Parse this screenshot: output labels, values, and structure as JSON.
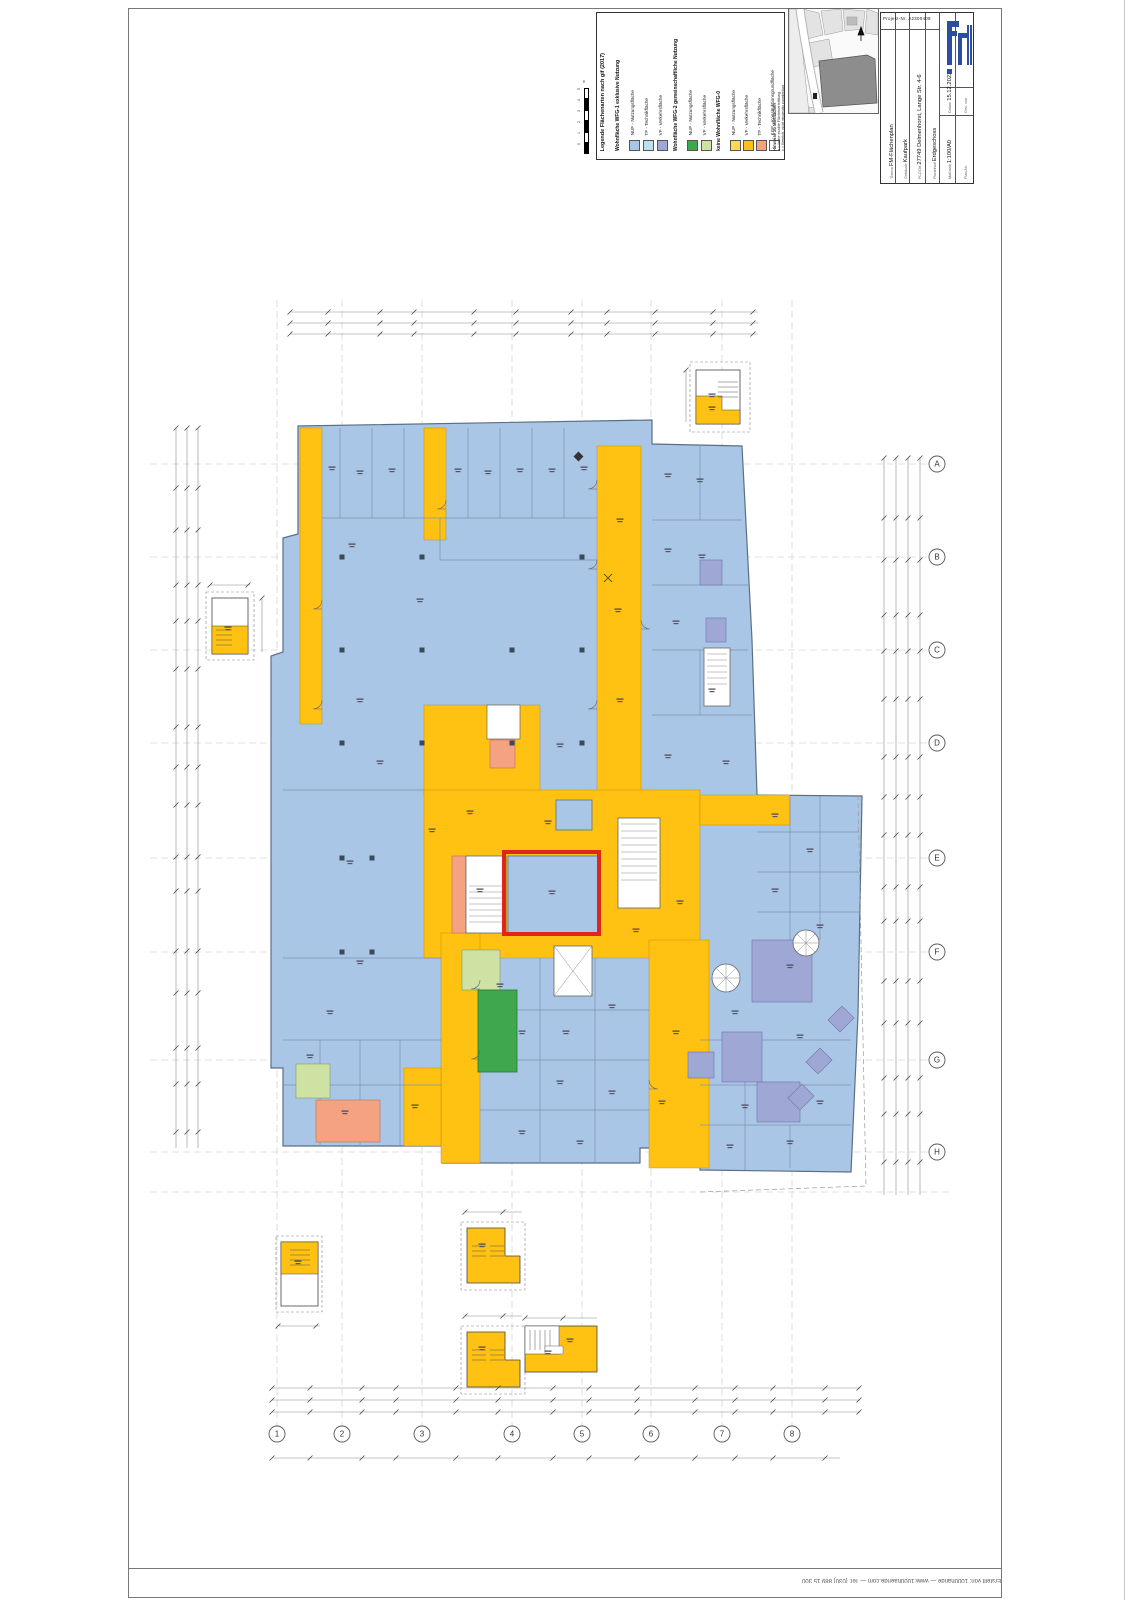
{
  "legend": {
    "title": "Legende Flächenarten nach gif (2017)",
    "groups": [
      {
        "header": "Wohnfläche WFG-1 exklusive Nutzung",
        "items": [
          {
            "label": "NUF - Nutzungsfläche",
            "color": "#A9C6E6"
          },
          {
            "label": "TF - Technikfläche",
            "color": "#BCE0EF"
          },
          {
            "label": "VF - Verkehrsfläche",
            "color": "#9FA8D5"
          }
        ]
      },
      {
        "header": "Wohnfläche WFG-2 gemeinschaftliche Nutzung",
        "items": [
          {
            "label": "NUF - Nutzungsfläche",
            "color": "#3FA84E"
          },
          {
            "label": "VF - Verkehrsfläche",
            "color": "#CDE2A3"
          }
        ]
      },
      {
        "header": "keine Wohnfläche WFG-0",
        "items": [
          {
            "label": "NUF - Nutzungsfläche",
            "color": "#FFD94F"
          },
          {
            "label": "VF - Verkehrsfläche",
            "color": "#FFC112"
          },
          {
            "label": "TF - Technikfläche",
            "color": "#F5A283"
          },
          {
            "label": "KGF - Konstruktionsgrundfläche",
            "color": "#FFFFFF"
          }
        ]
      }
    ],
    "notes": {
      "header": "Hinweise zu Mietflächen",
      "lines": [
        "a = keine exakte Flächenermittlung",
        "x = Bereich, nicht eindeutig zuordenbar"
      ]
    },
    "scale_bar": {
      "ticks": [
        "5",
        "4",
        "3",
        "2",
        "1",
        "0"
      ],
      "unit": "m"
    }
  },
  "title_block": {
    "project_label": "Projekt-Nr.",
    "project_number": "A2300409",
    "rows": [
      {
        "label": "Thema",
        "value": "FM-Flächenplan"
      },
      {
        "label": "Gebäude",
        "value": "Kaufpark"
      },
      {
        "label": "PLZ/Ort",
        "value": "27749 Delmenhorst, Lange Str. 4-6"
      },
      {
        "label": "Planinhalt",
        "value": "Erdgeschoss"
      }
    ],
    "meta": [
      {
        "label": "Datum",
        "value": "15.12.2023"
      },
      {
        "label": "Gez. von",
        "value": ""
      },
      {
        "label": "Maßstab",
        "value": "1:100/A0"
      },
      {
        "label": "Plan-Nr.",
        "value": ""
      }
    ]
  },
  "footer": {
    "credit": "Erstellt von: 1000hände  —  www.1000haende.com  —  Tel: (030) 889 15 300"
  },
  "plan": {
    "highlight_color": "#E0251B",
    "colors": {
      "wfg1_nuf_blue": "#A9C6E6",
      "wfg1_tf_lightblue": "#BCE0EF",
      "wfg1_vf_periwinkle": "#9FA8D5",
      "wfg2_nuf_green": "#3FA84E",
      "wfg2_vf_lightgreen": "#CDE2A3",
      "wfg0_nuf_yellow": "#FFD94F",
      "wfg0_vf_orange": "#FFC112",
      "wfg0_tf_salmon": "#F5A283",
      "kgf_white": "#FFFFFF"
    },
    "axes": {
      "bottom": [
        {
          "x": 277,
          "label": "1"
        },
        {
          "x": 342,
          "label": "2"
        },
        {
          "x": 422,
          "label": "3"
        },
        {
          "x": 512,
          "label": "4"
        },
        {
          "x": 582,
          "label": "5"
        },
        {
          "x": 651,
          "label": "6"
        },
        {
          "x": 722,
          "label": "7"
        },
        {
          "x": 792,
          "label": "8"
        }
      ],
      "right": [
        {
          "y": 464,
          "label": "A"
        },
        {
          "y": 557,
          "label": "B"
        },
        {
          "y": 650,
          "label": "C"
        },
        {
          "y": 743,
          "label": "D"
        },
        {
          "y": 858,
          "label": "E"
        },
        {
          "y": 952,
          "label": "F"
        },
        {
          "y": 1060,
          "label": "G"
        },
        {
          "y": 1152,
          "label": "H"
        }
      ]
    },
    "label_marks": [
      [
        332,
        468
      ],
      [
        360,
        472
      ],
      [
        392,
        470
      ],
      [
        458,
        470
      ],
      [
        488,
        472
      ],
      [
        520,
        470
      ],
      [
        552,
        470
      ],
      [
        584,
        468
      ],
      [
        352,
        545
      ],
      [
        420,
        600
      ],
      [
        360,
        700
      ],
      [
        380,
        762
      ],
      [
        350,
        862
      ],
      [
        360,
        962
      ],
      [
        330,
        1012
      ],
      [
        310,
        1056
      ],
      [
        345,
        1112
      ],
      [
        415,
        1106
      ],
      [
        668,
        475
      ],
      [
        700,
        480
      ],
      [
        668,
        550
      ],
      [
        702,
        556
      ],
      [
        676,
        622
      ],
      [
        712,
        690
      ],
      [
        668,
        756
      ],
      [
        726,
        762
      ],
      [
        620,
        520
      ],
      [
        618,
        610
      ],
      [
        620,
        700
      ],
      [
        560,
        745
      ],
      [
        548,
        822
      ],
      [
        552,
        892
      ],
      [
        636,
        930
      ],
      [
        500,
        985
      ],
      [
        522,
        1032
      ],
      [
        566,
        1032
      ],
      [
        612,
        1006
      ],
      [
        560,
        1082
      ],
      [
        612,
        1092
      ],
      [
        522,
        1132
      ],
      [
        580,
        1142
      ],
      [
        662,
        1102
      ],
      [
        676,
        1032
      ],
      [
        775,
        815
      ],
      [
        810,
        850
      ],
      [
        775,
        890
      ],
      [
        820,
        926
      ],
      [
        790,
        966
      ],
      [
        735,
        1012
      ],
      [
        800,
        1036
      ],
      [
        745,
        1106
      ],
      [
        790,
        1142
      ],
      [
        820,
        1102
      ],
      [
        730,
        1146
      ],
      [
        432,
        830
      ],
      [
        470,
        812
      ],
      [
        680,
        902
      ],
      [
        480,
        890
      ],
      [
        228,
        628
      ],
      [
        712,
        395
      ],
      [
        712,
        408
      ],
      [
        298,
        1262
      ],
      [
        482,
        1245
      ],
      [
        482,
        1348
      ],
      [
        548,
        1352
      ],
      [
        570,
        1340
      ]
    ],
    "columns": [
      [
        342,
        557
      ],
      [
        342,
        650
      ],
      [
        342,
        743
      ],
      [
        342,
        858
      ],
      [
        342,
        952
      ],
      [
        422,
        557
      ],
      [
        422,
        650
      ],
      [
        422,
        743
      ],
      [
        512,
        650
      ],
      [
        512,
        743
      ],
      [
        582,
        557
      ],
      [
        582,
        650
      ],
      [
        582,
        743
      ],
      [
        372,
        858
      ],
      [
        372,
        952
      ]
    ]
  }
}
